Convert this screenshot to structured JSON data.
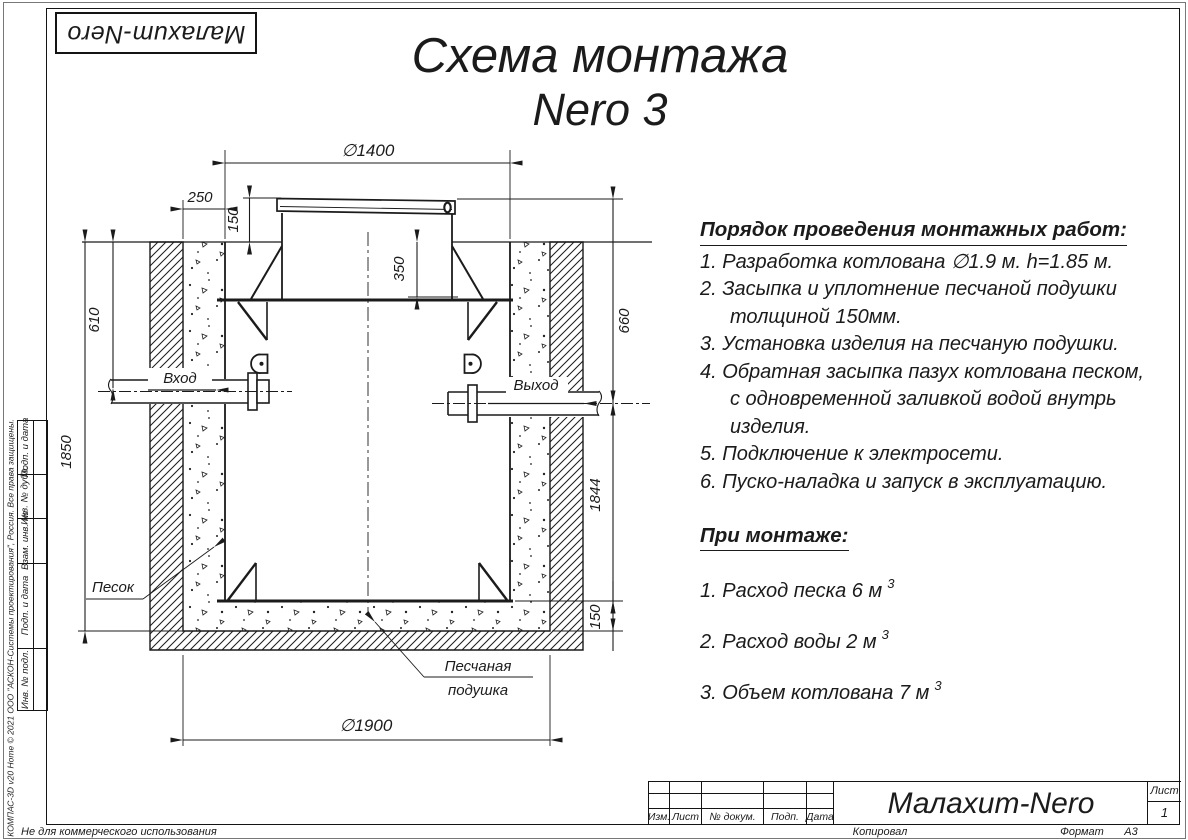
{
  "sheet": {
    "logo_text": "Малахит-Nero",
    "title_line1": "Схема монтажа",
    "title_line2": "Nero 3"
  },
  "instructions": {
    "heading": "Порядок проведения монтажных работ:",
    "items": [
      "1. Разработка котлована ∅1.9 м. h=1.85 м.",
      "2. Засыпка и уплотнение песчаной подушки толщиной 150мм.",
      "3. Установка изделия на песчаную подушки.",
      "4. Обратная засыпка пазух котлована песком, с одновременной заливкой водой внутрь изделия.",
      "5. Подключение к электросети.",
      "6. Пуско-наладка и запуск в эксплуатацию."
    ]
  },
  "montage": {
    "heading": "При монтаже:",
    "items": [
      {
        "text": "1. Расход песка 6 м",
        "sup": "3"
      },
      {
        "text": "2. Расход воды 2 м",
        "sup": "3"
      },
      {
        "text": "3. Объем котлована 7 м",
        "sup": "3"
      }
    ]
  },
  "drawing": {
    "dimensions": {
      "top_diameter": "∅1400",
      "wall_gap": "250",
      "cover_height": "150",
      "neck_depth": "350",
      "inlet_depth": "610",
      "pit_depth": "1850",
      "outlet_depth": "660",
      "body_height": "1844",
      "pad_thickness": "150",
      "pit_diameter": "∅1900"
    },
    "labels": {
      "inlet": "Вход",
      "outlet": "Выход",
      "sand": "Песок",
      "pad_line1": "Песчаная",
      "pad_line2": "подушка"
    }
  },
  "title_block": {
    "rev_columns": [
      "Изм.",
      "Лист",
      "№ докум.",
      "Подп.",
      "Дата"
    ],
    "product_title": "Малахит-Nero",
    "sheet_label": "Лист",
    "sheet_number": "1",
    "copied_label": "Копировал",
    "format_label": "Формат",
    "format_value": "А3"
  },
  "side_stamp": {
    "cells": [
      "Подп. и дата",
      "Инв. № дубл.",
      "Взам. инв. №",
      "Подп. и дата",
      "Инв. № подл."
    ],
    "copyright": "КОМПАС-3D v20 Home © 2021 ООО \"АСКОН-Системы проектирования\", Россия. Все права защищены.",
    "non_commercial": "Не для коммерческого использования"
  }
}
